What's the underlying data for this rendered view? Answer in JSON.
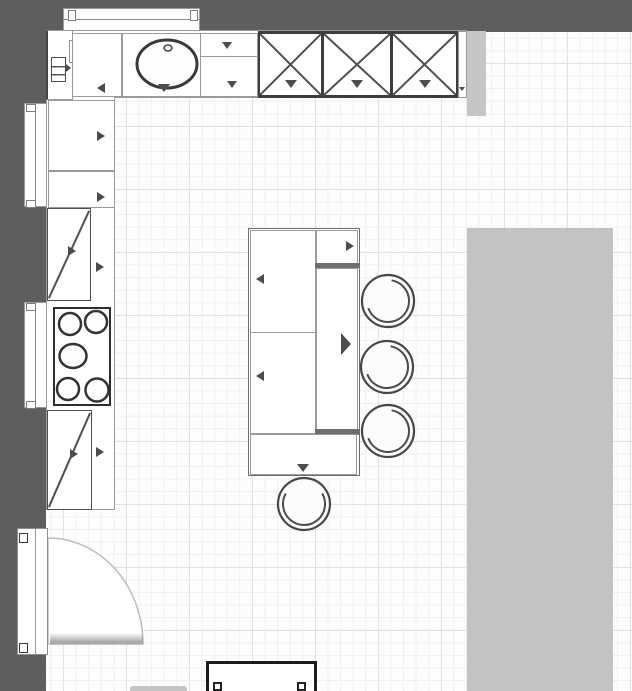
{
  "meta": {
    "title": "Kitchen floor plan",
    "view": "top-down 2D",
    "canvas_px": {
      "width": 632,
      "height": 691
    }
  },
  "colors": {
    "wall": "#5e5e5e",
    "floor": "#fdfdfd",
    "grid_minor": "#f0f0f0",
    "grid_major": "#e2e2e2",
    "fixture_fill": "#ffffff",
    "outline_light": "#9a9a9a",
    "outline_dark": "#3d3d3d",
    "arrow": "#4c4c4c",
    "shadow": "#6f6f6f",
    "area_block": "#c3c3c3"
  },
  "labels": {
    "sink": "Oval sink with faucet",
    "cooktop": "5-burner cooktop",
    "door": "Hinged entry door with quarter-circle swing",
    "stool": "Bar stool",
    "island": "Kitchen island",
    "window": "Window",
    "wall_cabinet": "Tall cabinet (X symbol)",
    "cabinet": "Base cabinet",
    "tall_cabinet": "Tall cabinet with diagonal symbol",
    "bench": "Bench / console (partially visible)",
    "area_block": "Gray area block (table / counter zone)",
    "filler": "Filler panel",
    "corner_cabinet": "Corner cabinet with appliance symbol",
    "drawer_cabinet": "Drawer cabinet",
    "blind_cabinet": "Blind corner cabinet",
    "wall_stub": "Wall stub / chimney"
  },
  "inventory": {
    "walls": [
      "top wall",
      "left wall"
    ],
    "windows": [
      {
        "wall": "top",
        "span": "above sink run"
      },
      {
        "wall": "left",
        "position": "upper, behind base cabinets"
      },
      {
        "wall": "left",
        "position": "middle, behind cooktop"
      }
    ],
    "door": {
      "count": 1,
      "wall": "left",
      "position": "lower",
      "swing": "opens into room"
    },
    "top_run_units": [
      "corner cabinet",
      "blind corner cabinet (arrow left)",
      "sink base cabinet (arrow down)",
      "split cabinet (2 arrows down)",
      "x-cabinet",
      "x-cabinet",
      "x-cabinet",
      "filler (small arrow)",
      "gray wall stub"
    ],
    "left_run_units": [
      "base cabinet (arrow right)",
      "base cabinet (arrow right)",
      "diagonal tall cabinet",
      "cooktop with 5 burners",
      "diagonal tall cabinet"
    ],
    "island": {
      "sections": [
        "upper door cabinet (arrow left)",
        "lower door cabinet (arrow left)",
        "small top-right cabinet (arrow right)",
        "tall counter panel (large arrow right)",
        "bottom end cabinet (arrow down)"
      ],
      "shadow_joints": 2
    },
    "seating": {
      "bar_stools_right_of_island": 3,
      "bar_stool_below_island": 1
    },
    "cooktop_burners": 5,
    "other_objects": [
      "large gray rectangle on right side",
      "bench at bottom edge (cut off)",
      "small gray object edge at bottom left"
    ]
  }
}
